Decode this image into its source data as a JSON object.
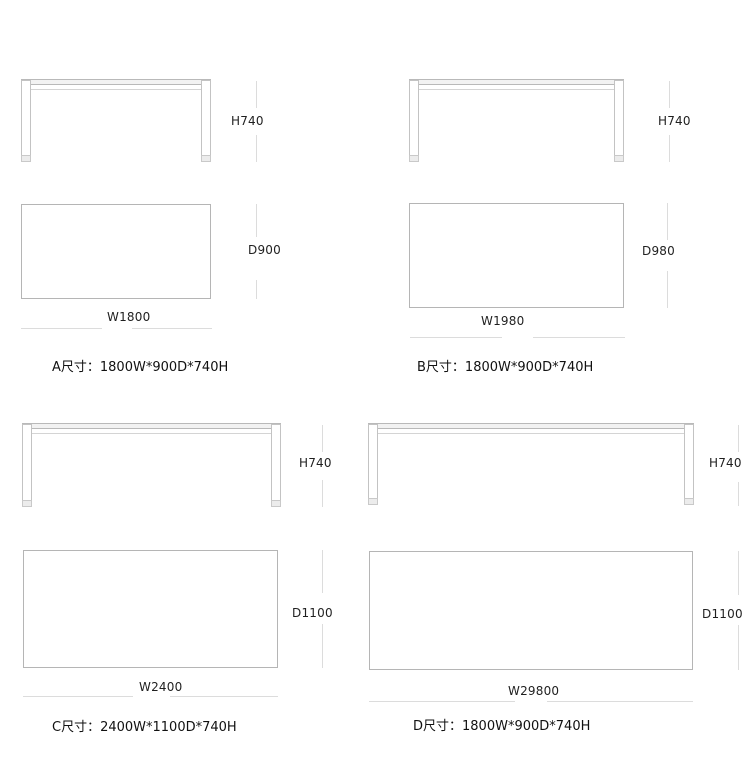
{
  "diagram_title": "table-dimension-diagram",
  "colors": {
    "background": "#ffffff",
    "drawing_line": "#bdbdbd",
    "dim_line": "#dcdcdc",
    "text": "#1f1f1f"
  },
  "tables": [
    {
      "id": "A",
      "height_label": "H740",
      "depth_label": "D900",
      "width_label": "W1800",
      "caption": "A尺寸：1800W*900D*740H"
    },
    {
      "id": "B",
      "height_label": "H740",
      "depth_label": "D980",
      "width_label": "W1980",
      "caption": "B尺寸：1800W*900D*740H"
    },
    {
      "id": "C",
      "height_label": "H740",
      "depth_label": "D1100",
      "width_label": "W2400",
      "caption": "C尺寸：2400W*1100D*740H"
    },
    {
      "id": "D",
      "height_label": "H740",
      "depth_label": "D1100",
      "width_label": "W29800",
      "caption": "D尺寸：1800W*900D*740H"
    }
  ]
}
